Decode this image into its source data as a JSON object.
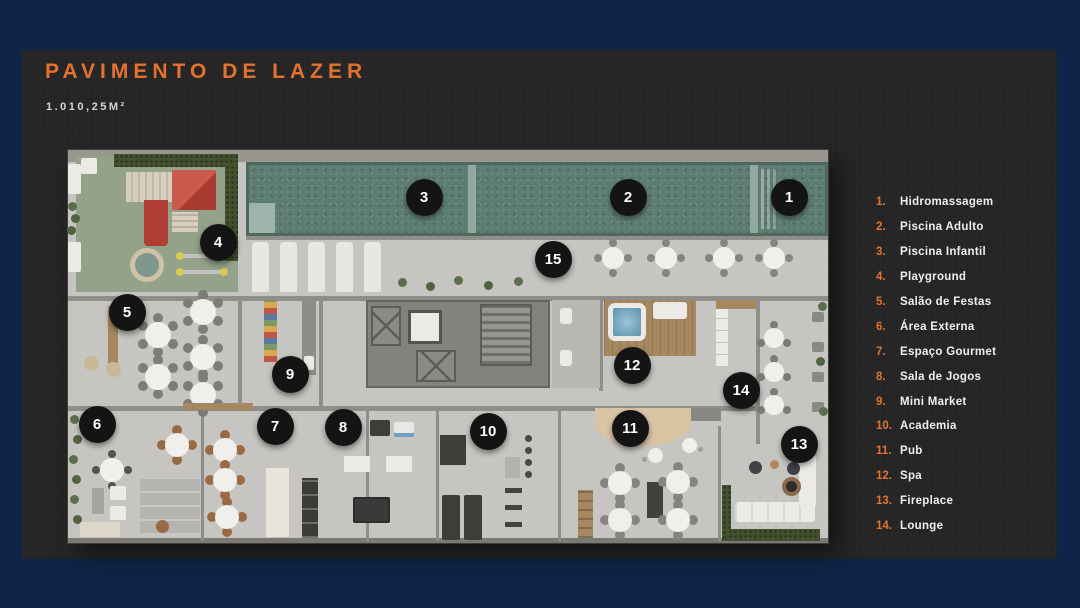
{
  "colors": {
    "navy": "#0e2547",
    "card": "#262626",
    "accent": "#e4722e",
    "marker": "#141414",
    "pool": "#5d7d74",
    "grass": "#93a289"
  },
  "header": {
    "title": "PAVIMENTO DE LAZER",
    "area": "1.010,25M²"
  },
  "legend": {
    "items": [
      {
        "num": "1.",
        "label": "Hidromassagem"
      },
      {
        "num": "2.",
        "label": "Piscina Adulto"
      },
      {
        "num": "3.",
        "label": "Piscina Infantil"
      },
      {
        "num": "4.",
        "label": "Playground"
      },
      {
        "num": "5.",
        "label": "Salão de Festas"
      },
      {
        "num": "6.",
        "label": "Área Externa"
      },
      {
        "num": "7.",
        "label": "Espaço Gourmet"
      },
      {
        "num": "8.",
        "label": "Sala de Jogos"
      },
      {
        "num": "9.",
        "label": "Mini Market"
      },
      {
        "num": "10.",
        "label": "Academia"
      },
      {
        "num": "11.",
        "label": "Pub"
      },
      {
        "num": "12.",
        "label": "Spa"
      },
      {
        "num": "13.",
        "label": "Fireplace"
      },
      {
        "num": "14.",
        "label": "Lounge"
      }
    ]
  },
  "plan": {
    "markers": [
      {
        "n": "1",
        "x": 721,
        "y": 47
      },
      {
        "n": "2",
        "x": 560,
        "y": 47
      },
      {
        "n": "3",
        "x": 356,
        "y": 47
      },
      {
        "n": "4",
        "x": 150,
        "y": 92
      },
      {
        "n": "5",
        "x": 59,
        "y": 162
      },
      {
        "n": "6",
        "x": 29,
        "y": 274
      },
      {
        "n": "7",
        "x": 207,
        "y": 276
      },
      {
        "n": "8",
        "x": 275,
        "y": 277
      },
      {
        "n": "9",
        "x": 222,
        "y": 224
      },
      {
        "n": "10",
        "x": 420,
        "y": 281
      },
      {
        "n": "11",
        "x": 562,
        "y": 278
      },
      {
        "n": "12",
        "x": 564,
        "y": 215
      },
      {
        "n": "13",
        "x": 731,
        "y": 294
      },
      {
        "n": "14",
        "x": 673,
        "y": 240
      },
      {
        "n": "15",
        "x": 485,
        "y": 109
      }
    ]
  }
}
